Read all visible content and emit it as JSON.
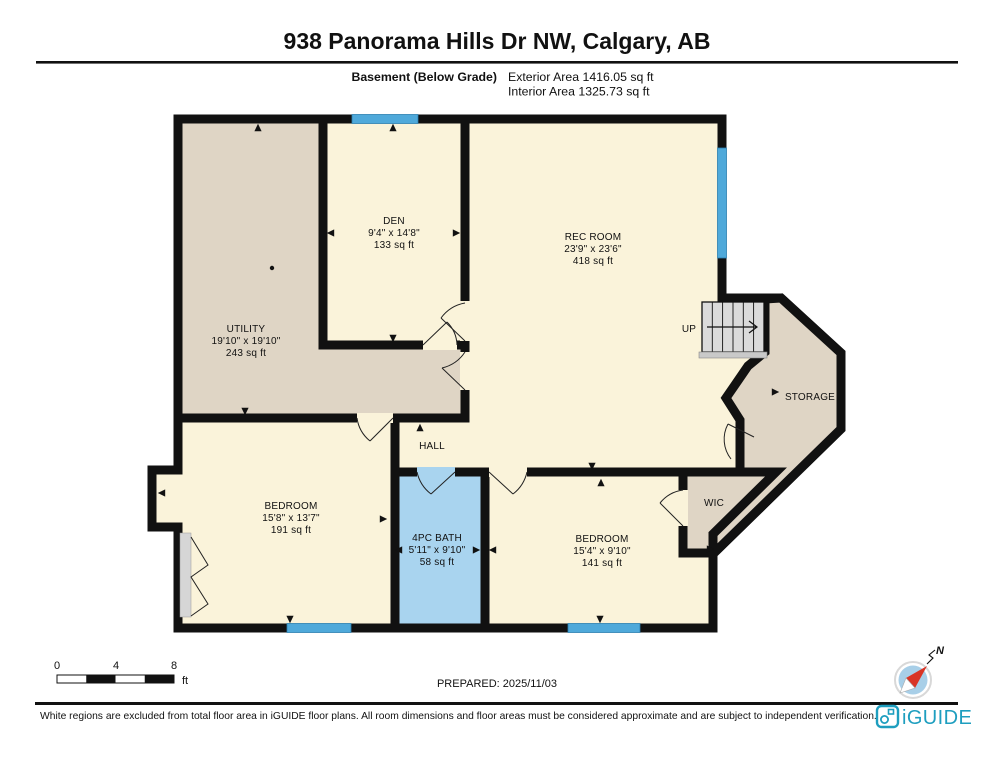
{
  "header": {
    "title": "938 Panorama Hills Dr NW, Calgary, AB",
    "floor_label": "Basement (Below Grade)",
    "exterior_area": "Exterior Area 1416.05 sq ft",
    "interior_area": "Interior Area 1325.73 sq ft"
  },
  "rooms": {
    "utility": {
      "name": "UTILITY",
      "dims": "19'10\" x 19'10\"",
      "area": "243 sq ft"
    },
    "den": {
      "name": "DEN",
      "dims": "9'4\" x 14'8\"",
      "area": "133 sq ft"
    },
    "rec_room": {
      "name": "REC ROOM",
      "dims": "23'9\" x 23'6\"",
      "area": "418 sq ft"
    },
    "bedroom_left": {
      "name": "BEDROOM",
      "dims": "15'8\" x 13'7\"",
      "area": "191 sq ft"
    },
    "bath": {
      "name": "4PC BATH",
      "dims": "5'11\" x 9'10\"",
      "area": "58 sq ft"
    },
    "bedroom_right": {
      "name": "BEDROOM",
      "dims": "15'4\" x 9'10\"",
      "area": "141 sq ft"
    },
    "hall": {
      "name": "HALL"
    },
    "wic": {
      "name": "WIC"
    },
    "storage": {
      "name": "STORAGE"
    },
    "stairs": {
      "label": "UP"
    }
  },
  "scale_bar": {
    "labels": [
      "0",
      "4",
      "8"
    ],
    "unit": "ft"
  },
  "prepared": "PREPARED: 2025/11/03",
  "compass": {
    "label": "N"
  },
  "footer": {
    "disclaimer": "White regions are excluded from total floor area in iGUIDE floor plans. All room dimensions and floor areas must be considered approximate and are subject to independent verification.",
    "brand": "iGUIDE"
  },
  "colors": {
    "room_cream": "#FAF3DA",
    "utility_tan": "#DFD5C5",
    "bath_blue": "#A9D4EF",
    "window_blue": "#4FA9DA",
    "wall_black": "#111111",
    "brand_teal": "#1E9EBF",
    "compass_red": "#D93425",
    "compass_blue": "#A8CFE8"
  }
}
